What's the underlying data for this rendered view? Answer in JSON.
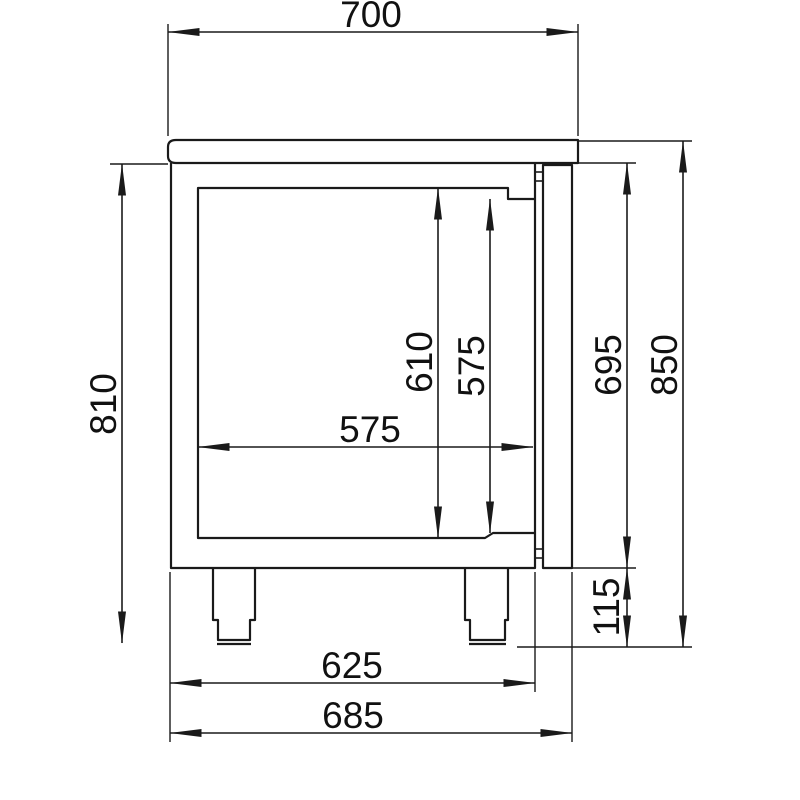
{
  "drawing": {
    "type": "technical-dimension-drawing",
    "subject": "refrigerated counter cabinet side section view",
    "background_color": "#ffffff",
    "line_color": "#1a1a1a",
    "text_color": "#111111",
    "dimensions": {
      "worktop_width": "700",
      "height_under_worktop": "810",
      "interior_height": "610",
      "door_opening_height": "575",
      "interior_depth": "575",
      "body_height_right": "695",
      "total_height": "850",
      "leg_height": "115",
      "body_depth": "625",
      "depth_with_door": "685"
    }
  }
}
